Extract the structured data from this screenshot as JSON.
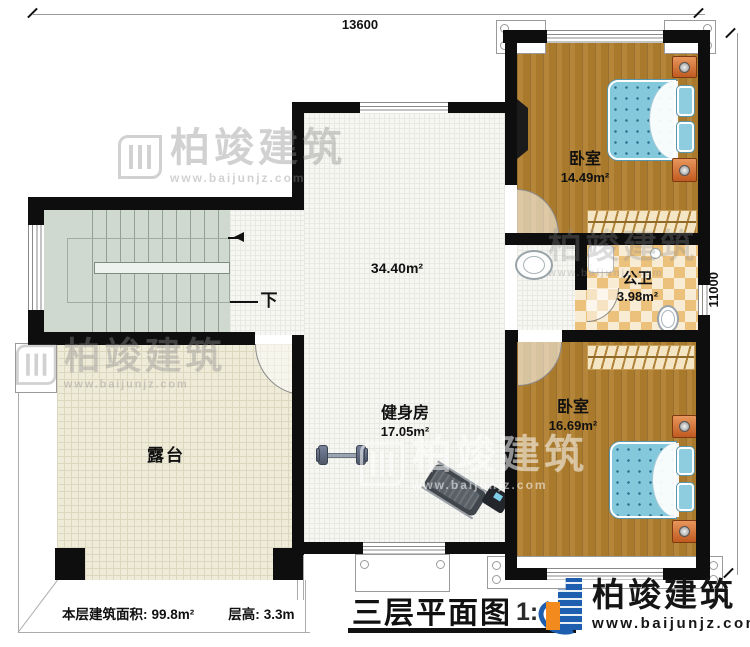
{
  "title": {
    "text": "三层平面图",
    "scale": "1:"
  },
  "dimensions": {
    "top": "13600",
    "right": "11000"
  },
  "rooms": [
    {
      "name": "卧室",
      "area": "14.49m²"
    },
    {
      "name": "公卫",
      "area": "3.98m²"
    },
    {
      "name": "卧室",
      "area": "16.69m²"
    },
    {
      "name": "健身房",
      "area": "17.05m²"
    },
    {
      "name": "",
      "area": "34.40m²"
    },
    {
      "name": "露台",
      "area": ""
    }
  ],
  "stair": {
    "down": "下"
  },
  "footer": {
    "area_label": "本层建筑面积:",
    "area_value": "99.8m²",
    "height_label": "层高:",
    "height_value": "3.3m"
  },
  "brand": {
    "name": "柏竣建筑",
    "url": "www.baijunjz.com"
  },
  "watermark": {
    "name": "柏竣建筑",
    "url": "www.baijunjz.com"
  },
  "colors": {
    "wall": "#0e0e0e",
    "wood": "#b28134",
    "bed": "#84c8dc",
    "tile": "#ecc17b",
    "stair": "#cfd9cf",
    "terrace": "#eeebd8",
    "brand_blue": "#1d5fae",
    "brand_orange": "#f28a1d"
  }
}
